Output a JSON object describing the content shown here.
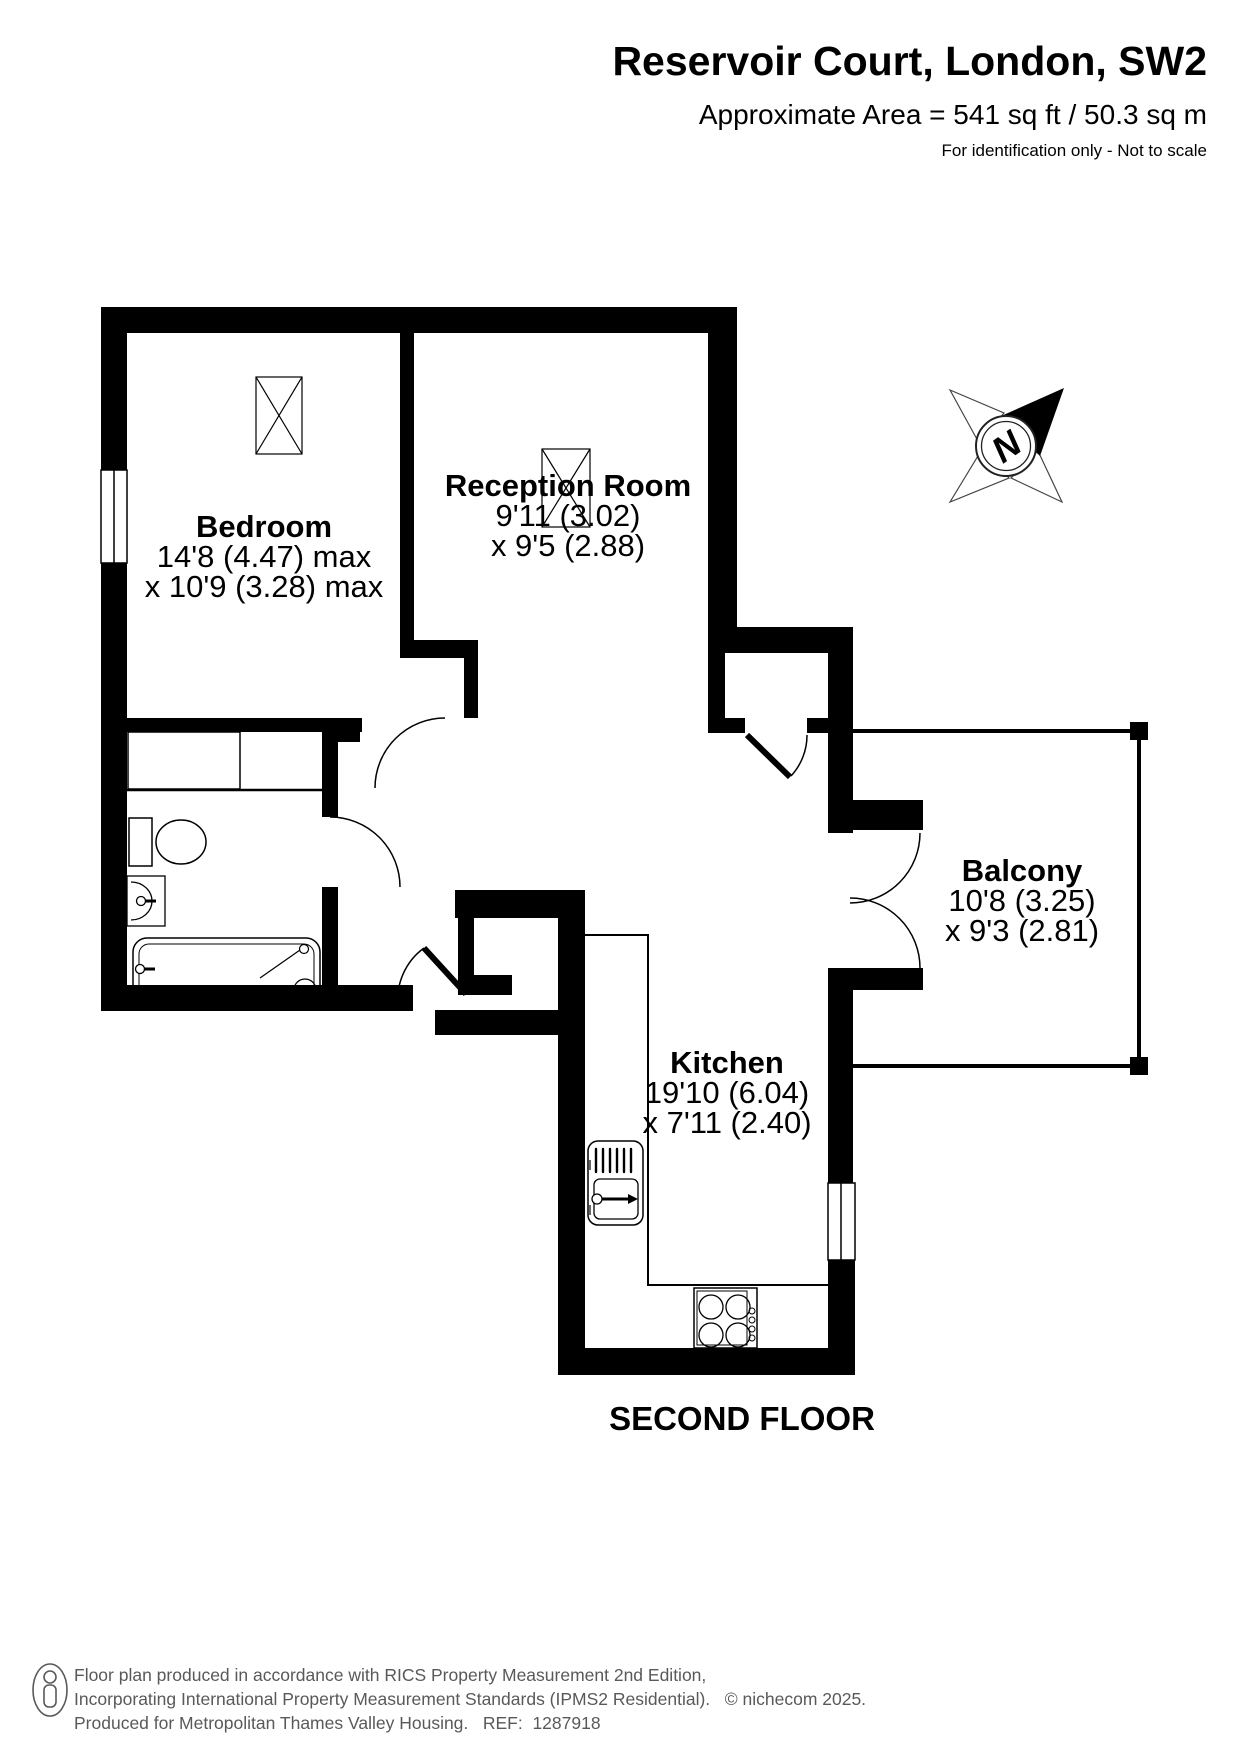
{
  "header": {
    "title": "Reservoir Court, London, SW2",
    "area": "Approximate Area = 541 sq ft / 50.3 sq m",
    "note": "For identification only - Not to scale"
  },
  "rooms": [
    {
      "name": "Bedroom",
      "dims1": "14'8 (4.47) max",
      "dims2": "x 10'9 (3.28) max"
    },
    {
      "name": "Reception Room",
      "dims1": "9'11 (3.02)",
      "dims2": "x 9'5 (2.88)"
    },
    {
      "name": "Balcony",
      "dims1": "10'8 (3.25)",
      "dims2": "x 9'3 (2.81)"
    },
    {
      "name": "Kitchen",
      "dims1": "19'10 (6.04)",
      "dims2": "x 7'11 (2.40)"
    }
  ],
  "floor_label": "SECOND FLOOR",
  "compass": {
    "letter": "N",
    "icon": "compass-rose-icon"
  },
  "colors": {
    "walls": "#000000",
    "footer_text": "#58595b",
    "background": "#ffffff"
  },
  "footer": {
    "icon": "person-icon",
    "line1": "Floor plan produced in accordance with RICS Property Measurement 2nd Edition,",
    "line2": "Incorporating International Property Measurement Standards (IPMS2 Residential).   © nichecom 2025.",
    "line3": "Produced for Metropolitan Thames Valley Housing.   REF:  1287918"
  }
}
